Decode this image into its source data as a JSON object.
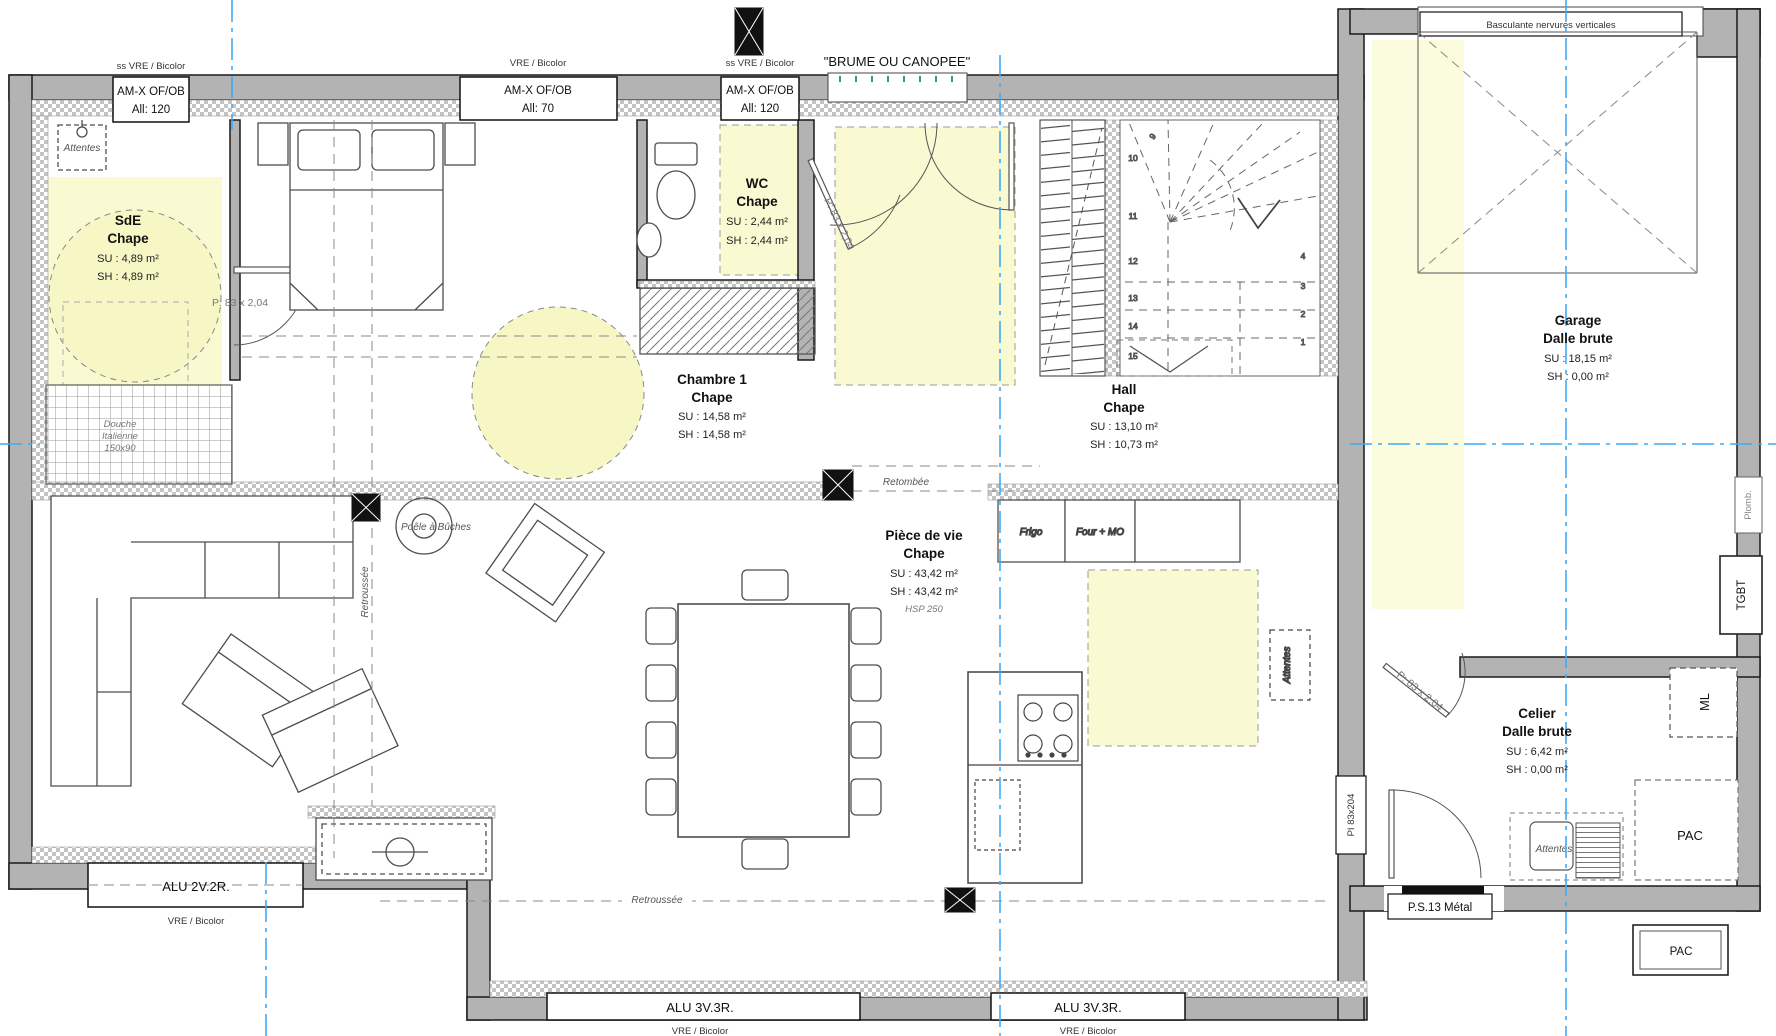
{
  "colors": {
    "wall": "#b3b3b3",
    "highlight_yellow": "#fafad2",
    "axis_blue": "#3fa9f5",
    "canopy_tick": "#2a9d8f"
  },
  "top_windows": {
    "w1": {
      "tag": "ss VRE / Bicolor",
      "name": "AM-X OF/OB",
      "alle": "All: 120"
    },
    "w2": {
      "tag": "VRE / Bicolor",
      "name": "AM-X OF/OB",
      "alle": "All: 70"
    },
    "w3": {
      "tag": "ss VRE / Bicolor",
      "name": "AM-X OF/OB",
      "alle": "All: 120"
    },
    "canopy": "\"BRUME OU CANOPEE\"",
    "garage_door": "Basculante nervures verticales"
  },
  "bottom_windows": {
    "alu2": {
      "label": "ALU 2V.2R.",
      "tag": "VRE / Bicolor"
    },
    "alu3a": {
      "label": "ALU 3V.3R.",
      "tag": "VRE / Bicolor"
    },
    "alu3b": {
      "label": "ALU 3V.3R.",
      "tag": "VRE / Bicolor"
    },
    "ps13": "P.S.13 Métal"
  },
  "rooms": {
    "sde": {
      "name": "SdE",
      "floor": "Chape",
      "su": "SU : 4,89 m²",
      "sh": "SH : 4,89 m²"
    },
    "wc": {
      "name": "WC",
      "floor": "Chape",
      "su": "SU : 2,44 m²",
      "sh": "SH : 2,44 m²"
    },
    "chambre1": {
      "name": "Chambre 1",
      "floor": "Chape",
      "su": "SU : 14,58 m²",
      "sh": "SH : 14,58 m²"
    },
    "hall": {
      "name": "Hall",
      "floor": "Chape",
      "su": "SU : 13,10 m²",
      "sh": "SH : 10,73 m²"
    },
    "piece_de_vie": {
      "name": "Pièce de vie",
      "floor": "Chape",
      "su": "SU : 43,42 m²",
      "sh": "SH : 43,42 m²",
      "note": "HSP 250"
    },
    "garage": {
      "name": "Garage",
      "floor": "Dalle brute",
      "su": "SU : 18,15 m²",
      "sh": "SH : 0,00 m²"
    },
    "celier": {
      "name": "Celier",
      "floor": "Dalle brute",
      "su": "SU : 6,42 m²",
      "sh": "SH : 0,00 m²"
    }
  },
  "doors": {
    "p83": "P: 83 x 2,04",
    "pi83": "PI 83x204"
  },
  "annotations": {
    "attentes": "Attentes",
    "douche_l1": "Douche",
    "douche_l2": "Italienne",
    "douche_l3": "150x90",
    "retombee": "Retombée",
    "retroussee": "Retroussée",
    "poele": "Poêle à Bûches",
    "frigo": "Frigo",
    "four_mo": "Four + MO",
    "plomb": "Plomb.",
    "tgbt": "TGBT",
    "ml": "ML",
    "pac": "PAC"
  },
  "stairs": {
    "s1": "1",
    "s2": "2",
    "s3": "3",
    "s4": "4",
    "s9": "9",
    "s10": "10",
    "s11": "11",
    "s12": "12",
    "s13": "13",
    "s14": "14",
    "s15": "15"
  }
}
